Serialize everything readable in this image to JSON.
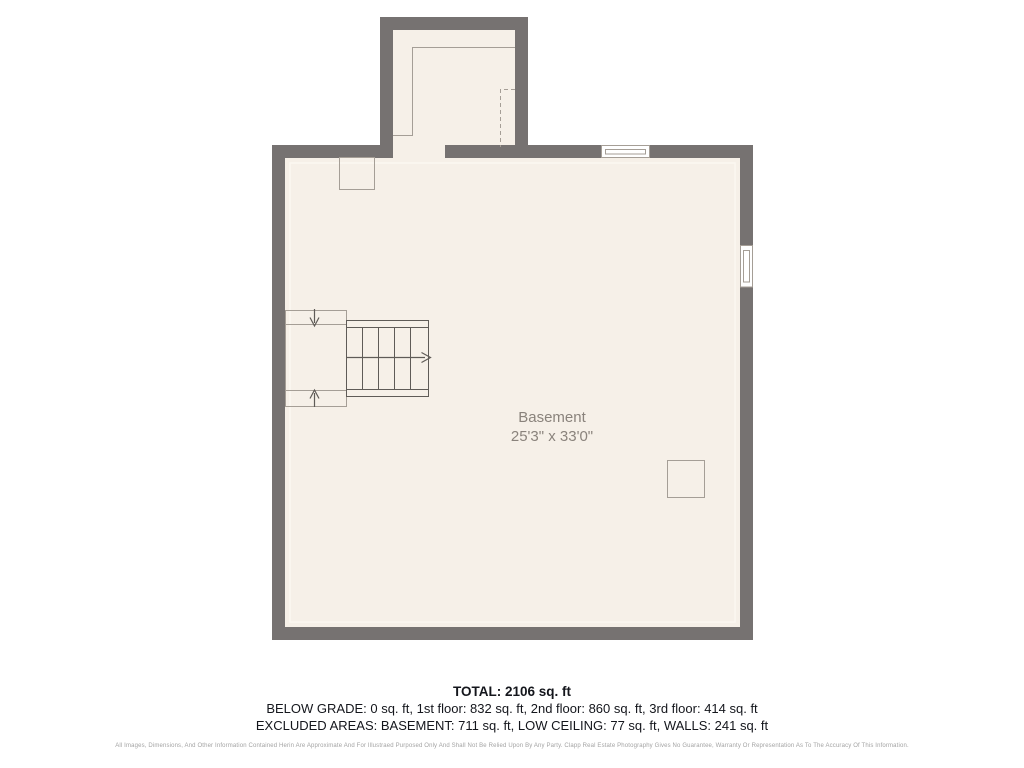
{
  "plan": {
    "room_label": "Basement",
    "room_dimensions": "25'3\" x 33'0\"",
    "colors": {
      "wall": "#767271",
      "floor": "#f6f0e8",
      "glow": "#fbf7f1",
      "line-light": "#a59e96",
      "line-dark": "#5f5b57",
      "label": "#8a837c",
      "text": "#14161c",
      "muted": "#a3a3a3"
    }
  },
  "summary": {
    "total": "TOTAL: 2106 sq. ft",
    "floors": "BELOW GRADE: 0 sq. ft, 1st floor: 832 sq. ft, 2nd floor: 860 sq. ft, 3rd floor: 414 sq. ft",
    "excluded": "EXCLUDED AREAS: BASEMENT: 711 sq. ft, LOW CEILING: 77 sq. ft, WALLS: 241 sq. ft"
  },
  "disclaimer": "All Images, Dimensions, And Other Information Contained Herin Are Approximate And For Illustraed Purposed Only And Shall Not Be Relied Upon By Any Party. Clapp Real Estate Photography Gives No Guarantee, Warranty Or Representation As To The Accuracy Of This Information."
}
